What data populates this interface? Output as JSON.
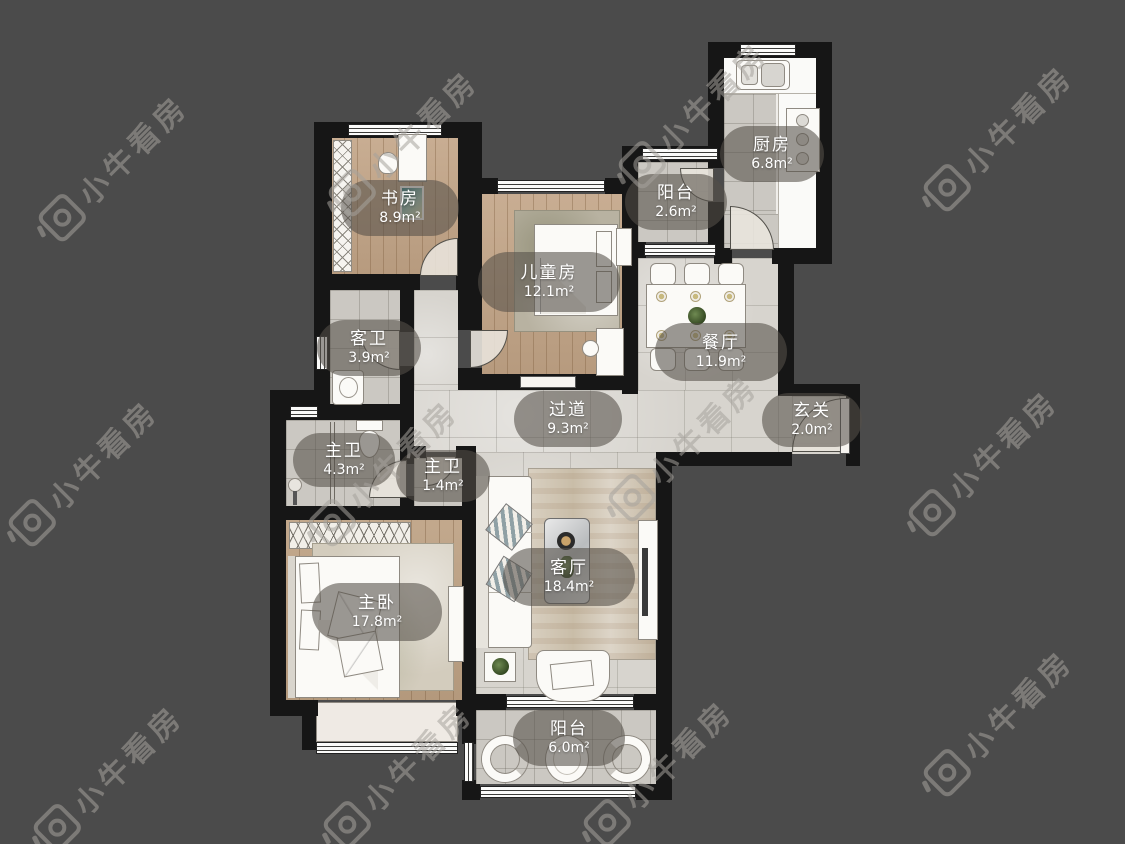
{
  "title": "户型图",
  "watermark": {
    "text": "小牛看房"
  },
  "colors": {
    "background": "#4b4b4b",
    "wall": "#161616",
    "tile_floor": "#cbc8c2",
    "corridor_floor": "#d7d4ce",
    "wood_floor": "#c2a486",
    "label_bubble": "rgba(84,80,72,0.58)",
    "label_text": "#ffffff"
  },
  "rooms": [
    {
      "id": "study",
      "name": "书房",
      "area": "8.9m²"
    },
    {
      "id": "children_room",
      "name": "儿童房",
      "area": "12.1m²"
    },
    {
      "id": "balcony_top",
      "name": "阳台",
      "area": "2.6m²"
    },
    {
      "id": "kitchen",
      "name": "厨房",
      "area": "6.8m²"
    },
    {
      "id": "guest_bath",
      "name": "客卫",
      "area": "3.9m²"
    },
    {
      "id": "dining",
      "name": "餐厅",
      "area": "11.9m²"
    },
    {
      "id": "hallway",
      "name": "过道",
      "area": "9.3m²"
    },
    {
      "id": "entry",
      "name": "玄关",
      "area": "2.0m²"
    },
    {
      "id": "master_bath",
      "name": "主卫",
      "area": "4.3m²"
    },
    {
      "id": "master_bath_small",
      "name": "主卫",
      "area": "1.4m²"
    },
    {
      "id": "master_bedroom",
      "name": "主卧",
      "area": "17.8m²"
    },
    {
      "id": "living_room",
      "name": "客厅",
      "area": "18.4m²"
    },
    {
      "id": "balcony_bottom",
      "name": "阳台",
      "area": "6.0m²"
    }
  ]
}
